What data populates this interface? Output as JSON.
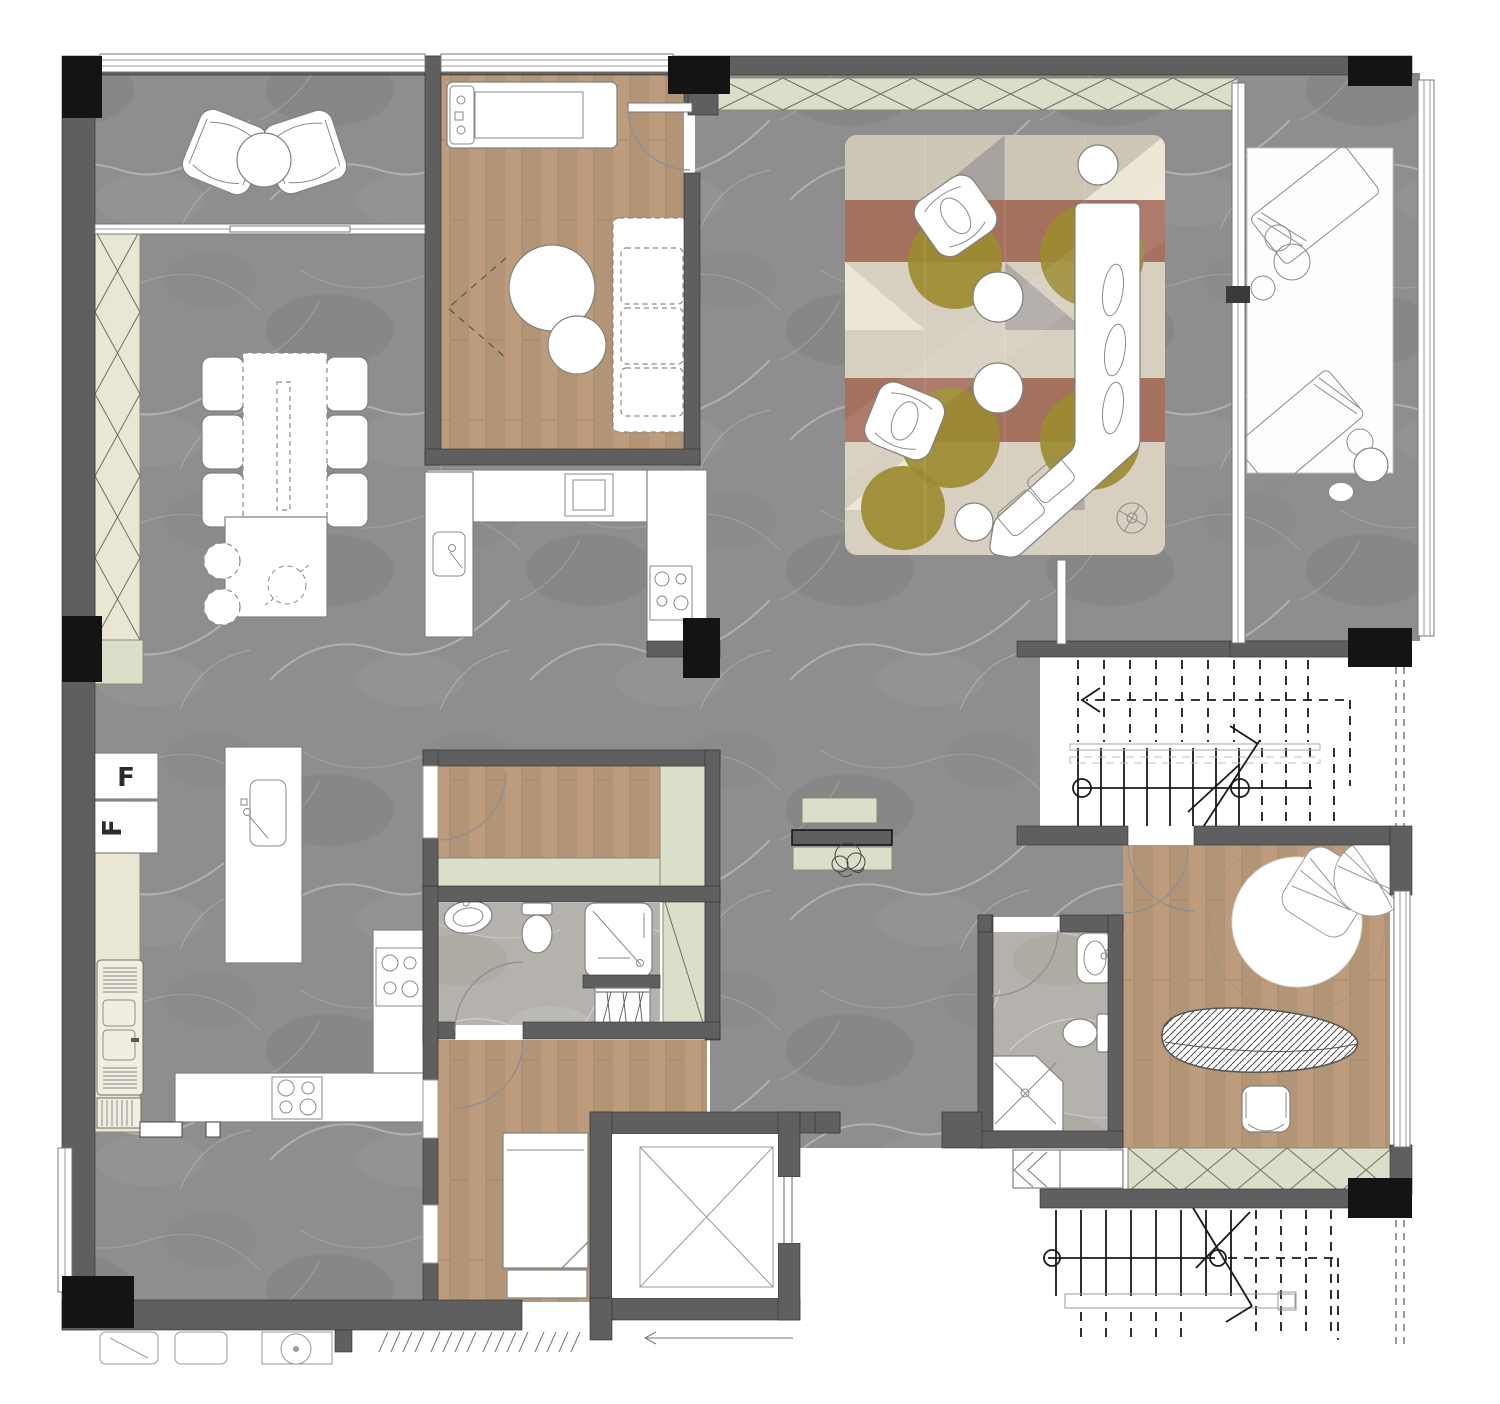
{
  "title": "apartment-floor-plan",
  "labels": {
    "fridge_1": "F",
    "fridge_2": "F"
  },
  "colors": {
    "wall": "#5f5f5f",
    "column": "#141414",
    "marble": "#8e8e8e",
    "marble_light": "#b5b2ad",
    "wood": "#bc9c7c",
    "wood_line": "#a27f5c",
    "cream": "#e9e6d3",
    "sage": "#d9dfc8",
    "rug_base": "#d7d0c0",
    "rug_band": "#a6705f",
    "rug_olive": "#9c8a31",
    "rug_cream": "#ece6d6",
    "rug_gray": "#a09a9b",
    "deck": "#fdfdfd",
    "outline": "#777777"
  },
  "icons": [
    "armchair-icon",
    "round-table-icon",
    "dining-table-icon",
    "chair-icon",
    "stool-icon",
    "kitchen-island-icon",
    "sink-icon",
    "cooktop-icon",
    "fridge-icon",
    "treadmill-icon",
    "pouf-icon",
    "sofa-icon",
    "l-sofa-icon",
    "floor-lamp-icon",
    "rug-icon",
    "lounge-chair-icon",
    "plant-icon",
    "stair-icon",
    "elevator-icon",
    "bed-icon",
    "toilet-icon",
    "shower-icon",
    "washing-machine-icon",
    "wardrobe-icon",
    "console-icon",
    "drying-rack-icon",
    "door-arc-icon"
  ]
}
